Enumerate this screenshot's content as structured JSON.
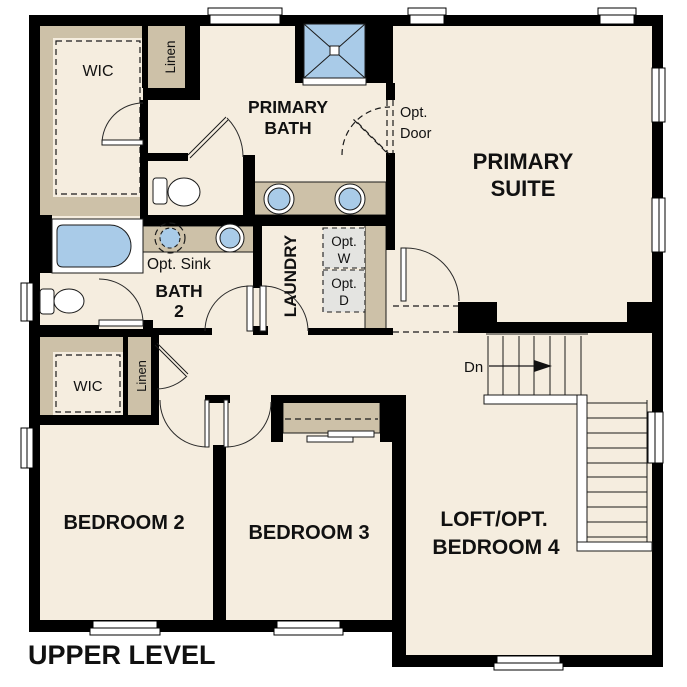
{
  "plan": {
    "level_title": "UPPER LEVEL",
    "rooms": {
      "primary_suite": {
        "line1": "PRIMARY",
        "line2": "SUITE"
      },
      "primary_bath": {
        "line1": "PRIMARY",
        "line2": "BATH"
      },
      "bath2": {
        "line1": "BATH",
        "line2": "2"
      },
      "laundry": {
        "label": "LAUNDRY"
      },
      "bedroom2": {
        "label": "BEDROOM 2"
      },
      "bedroom3": {
        "label": "BEDROOM 3"
      },
      "loft": {
        "line1": "LOFT/OPT.",
        "line2": "BEDROOM 4"
      },
      "wic_primary": {
        "label": "WIC"
      },
      "wic_bedroom2": {
        "label": "WIC"
      },
      "linen_upper": {
        "label": "Linen"
      },
      "linen_lower": {
        "label": "Linen"
      }
    },
    "annotations": {
      "opt_door": {
        "line1": "Opt.",
        "line2": "Door"
      },
      "opt_sink": {
        "label": "Opt. Sink"
      },
      "opt_washer": {
        "line1": "Opt.",
        "line2": "W"
      },
      "opt_dryer": {
        "line1": "Opt.",
        "line2": "D"
      },
      "stairs_down": {
        "label": "Dn"
      }
    },
    "colors": {
      "wall": "#000000",
      "floor": "#f5eddf",
      "poche": "#cdc1a8",
      "fixture_blue": "#a9cbe8",
      "optional_gray": "#e4e4e1",
      "window_white": "#ffffff",
      "background": "#ffffff"
    }
  }
}
